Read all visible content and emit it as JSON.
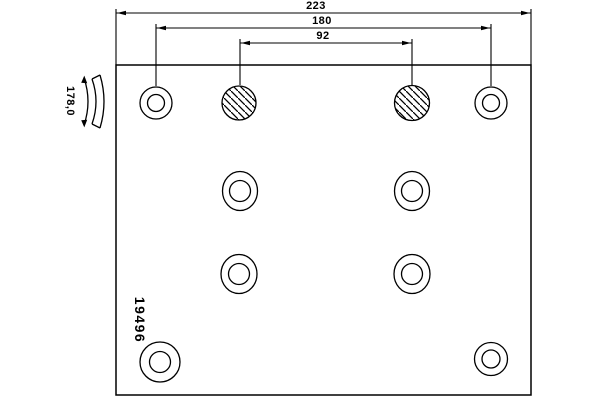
{
  "drawing": {
    "part_number": "19496",
    "dimension_labels": {
      "overall_width": "223",
      "outer_hole_spacing": "180",
      "inner_hole_spacing": "92",
      "profile_arc": "178,0"
    },
    "colors": {
      "line": "#000000",
      "background": "#ffffff"
    },
    "holes": {
      "plain_count": 8,
      "hatched_count": 2
    }
  }
}
